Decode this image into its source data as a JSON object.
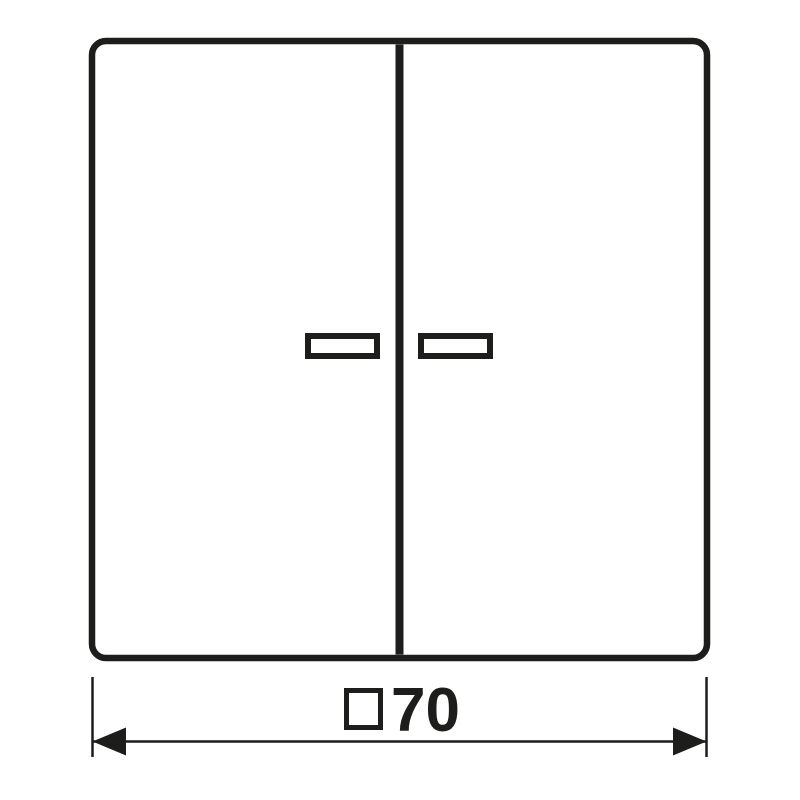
{
  "drawing": {
    "kind": "technical-dimension-drawing",
    "description": "Two-gang rocker switch front view with indicator windows"
  },
  "dimension": {
    "symbol_icon": "square-symbol",
    "value": "70",
    "full_label": "□70"
  },
  "colors": {
    "line": "#1d1d1b",
    "background": "#ffffff"
  }
}
